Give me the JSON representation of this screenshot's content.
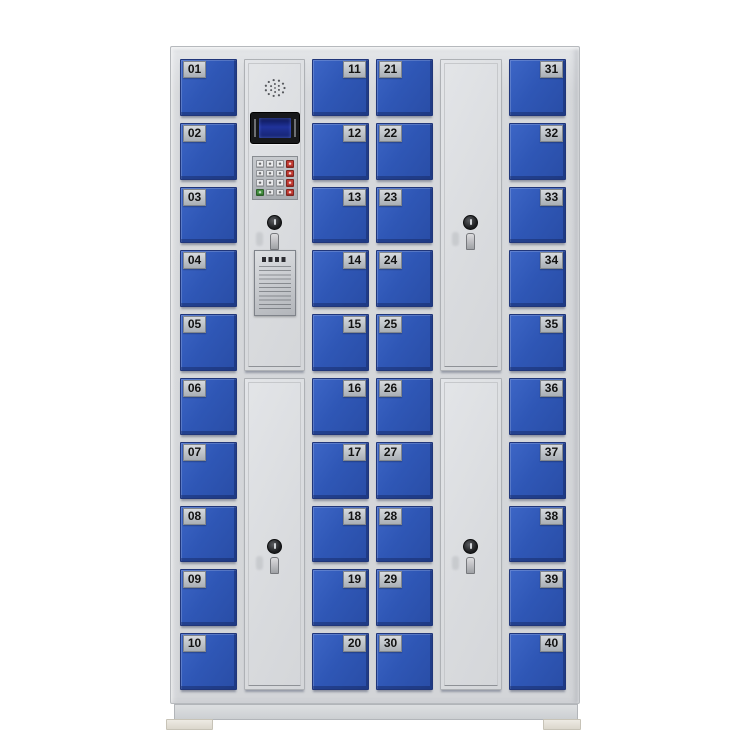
{
  "cabinet": {
    "description_name": "electronic-storage-locker-40-doors",
    "columns": [
      {
        "id": "col-1",
        "type": "lockers",
        "label_side": "left",
        "doors": [
          "01",
          "02",
          "03",
          "04",
          "05",
          "06",
          "07",
          "08",
          "09",
          "10"
        ]
      },
      {
        "id": "col-2",
        "type": "control",
        "panel_components": [
          "speaker-grille",
          "lcd-display",
          "keypad",
          "key-lock",
          "instruction-plate"
        ],
        "lower_door_has_lock": true
      },
      {
        "id": "col-3",
        "type": "lockers",
        "label_side": "right",
        "doors": [
          "11",
          "12",
          "13",
          "14",
          "15",
          "16",
          "17",
          "18",
          "19",
          "20"
        ]
      },
      {
        "id": "col-4",
        "type": "lockers",
        "label_side": "left",
        "doors": [
          "21",
          "22",
          "23",
          "24",
          "25",
          "26",
          "27",
          "28",
          "29",
          "30"
        ]
      },
      {
        "id": "col-5",
        "type": "tall",
        "doors": [
          {
            "lock": true
          },
          {
            "lock": true
          }
        ]
      },
      {
        "id": "col-6",
        "type": "lockers",
        "label_side": "right",
        "doors": [
          "31",
          "32",
          "33",
          "34",
          "35",
          "36",
          "37",
          "38",
          "39",
          "40"
        ]
      }
    ],
    "keypad": {
      "rows": 4,
      "cols": 4,
      "right_column_key_color": "#c23a32",
      "bottom_left_key_color": "#43903f",
      "key_color": "#e9eaec"
    },
    "colors": {
      "door_blue": "#2f57b6",
      "door_blue_dark": "#24479e",
      "frame_gray": "#d4d6d9",
      "panel_gray": "#dcdee1",
      "label_plate": "#b9bdc2",
      "label_text": "#131313",
      "lcd_screen": "#20339b",
      "lcd_bezel": "#17181a",
      "background": "#ffffff"
    }
  }
}
